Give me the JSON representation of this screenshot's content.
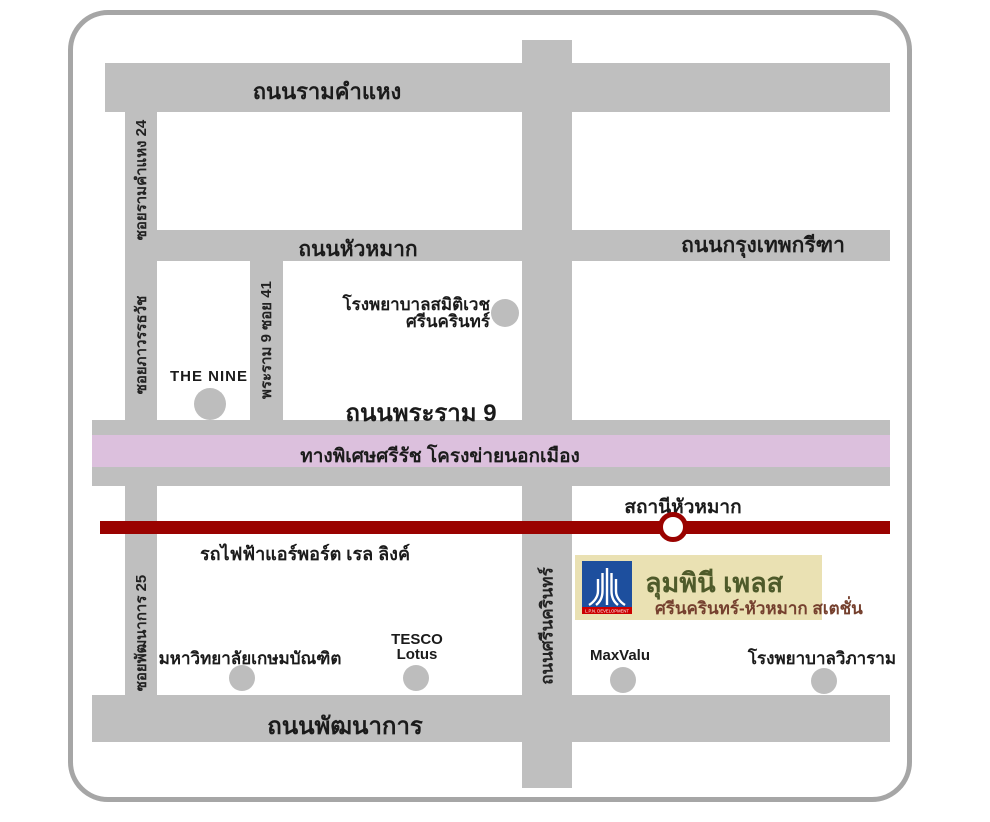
{
  "colors": {
    "road_gray": "#bfbfbf",
    "expressway_pink": "#dcc0dd",
    "rail_red": "#9a0200",
    "project_box_bg": "#eae1b3",
    "logo_blue": "#1d4f9e",
    "logo_red": "#cc0000",
    "project_name_green": "#4e5a2a",
    "project_subtitle_maroon": "#75402e"
  },
  "roads": {
    "ramkhamhaeng": "ถนนรามคำแหง",
    "soi_ramkhamhaeng_24": "ซอยรามคำแหง 24",
    "soi_phawanthawat": "ซอยภาวรรธวัช",
    "soi_pattanakarn_25": "ซอยพัฒนาการ 25",
    "huamak": "ถนนหัวหมาก",
    "krungthep_kreetha": "ถนนกรุงเทพกรีฑา",
    "rama9_soi41": "พระราม 9 ซอย 41",
    "rama9": "ถนนพระราม 9",
    "srinagarindra": "ถนนศรีนครินทร์",
    "pattanakarn": "ถนนพัฒนาการ"
  },
  "expressway": {
    "label": "ทางพิเศษศรีรัช โครงข่ายนอกเมือง"
  },
  "rail": {
    "line_label": "รถไฟฟ้าแอร์พอร์ต เรล ลิงค์",
    "station_label": "สถานีหัวหมาก"
  },
  "landmarks": {
    "samitivej_line1": "โรงพยาบาลสมิติเวช",
    "samitivej_line2": "ศรีนครินทร์",
    "the_nine": "THE NINE",
    "kasem_bundit": "มหาวิทยาลัยเกษมบัณฑิต",
    "tesco_line1": "TESCO",
    "tesco_line2": "Lotus",
    "maxvalu": "MaxValu",
    "vibharam": "โรงพยาบาลวิภาราม"
  },
  "project": {
    "name": "ลุมพินี เพลส",
    "subtitle": "ศรีนครินทร์-หัวหมาก สเตชั่น",
    "logo_caption": "L.P.N. DEVELOPMENT"
  }
}
